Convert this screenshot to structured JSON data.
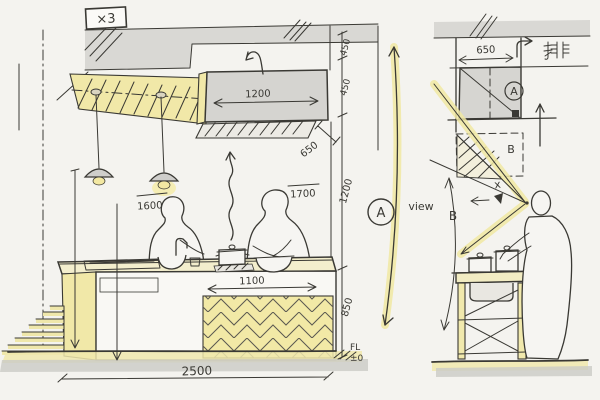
{
  "colors": {
    "paper": "#f4f3ef",
    "ink": "#3a3934",
    "gray_fill": "#d8d7d3",
    "accent_yellow": "#f1e8a8",
    "floor_shadow": "#cbcac6"
  },
  "tag": {
    "label": "×3"
  },
  "elevation": {
    "hood_width": "1200",
    "hood_depth": "650",
    "dim_ceiling": "450",
    "dim_hood": "450",
    "dim_mid": "1200",
    "dim_counter": "850",
    "person_back_height": "1600",
    "person_front_height": "1700",
    "island_width": "1100",
    "overall_width": "2500",
    "floor_label": "FL",
    "floor_level": "±0"
  },
  "section": {
    "hood_depth": "650",
    "exhaust_kanji": "排",
    "zone_a": "A",
    "zone_b": "B",
    "blocked_mark": "x",
    "view_tag": "A",
    "view_label": "view",
    "height_tag": "B"
  }
}
